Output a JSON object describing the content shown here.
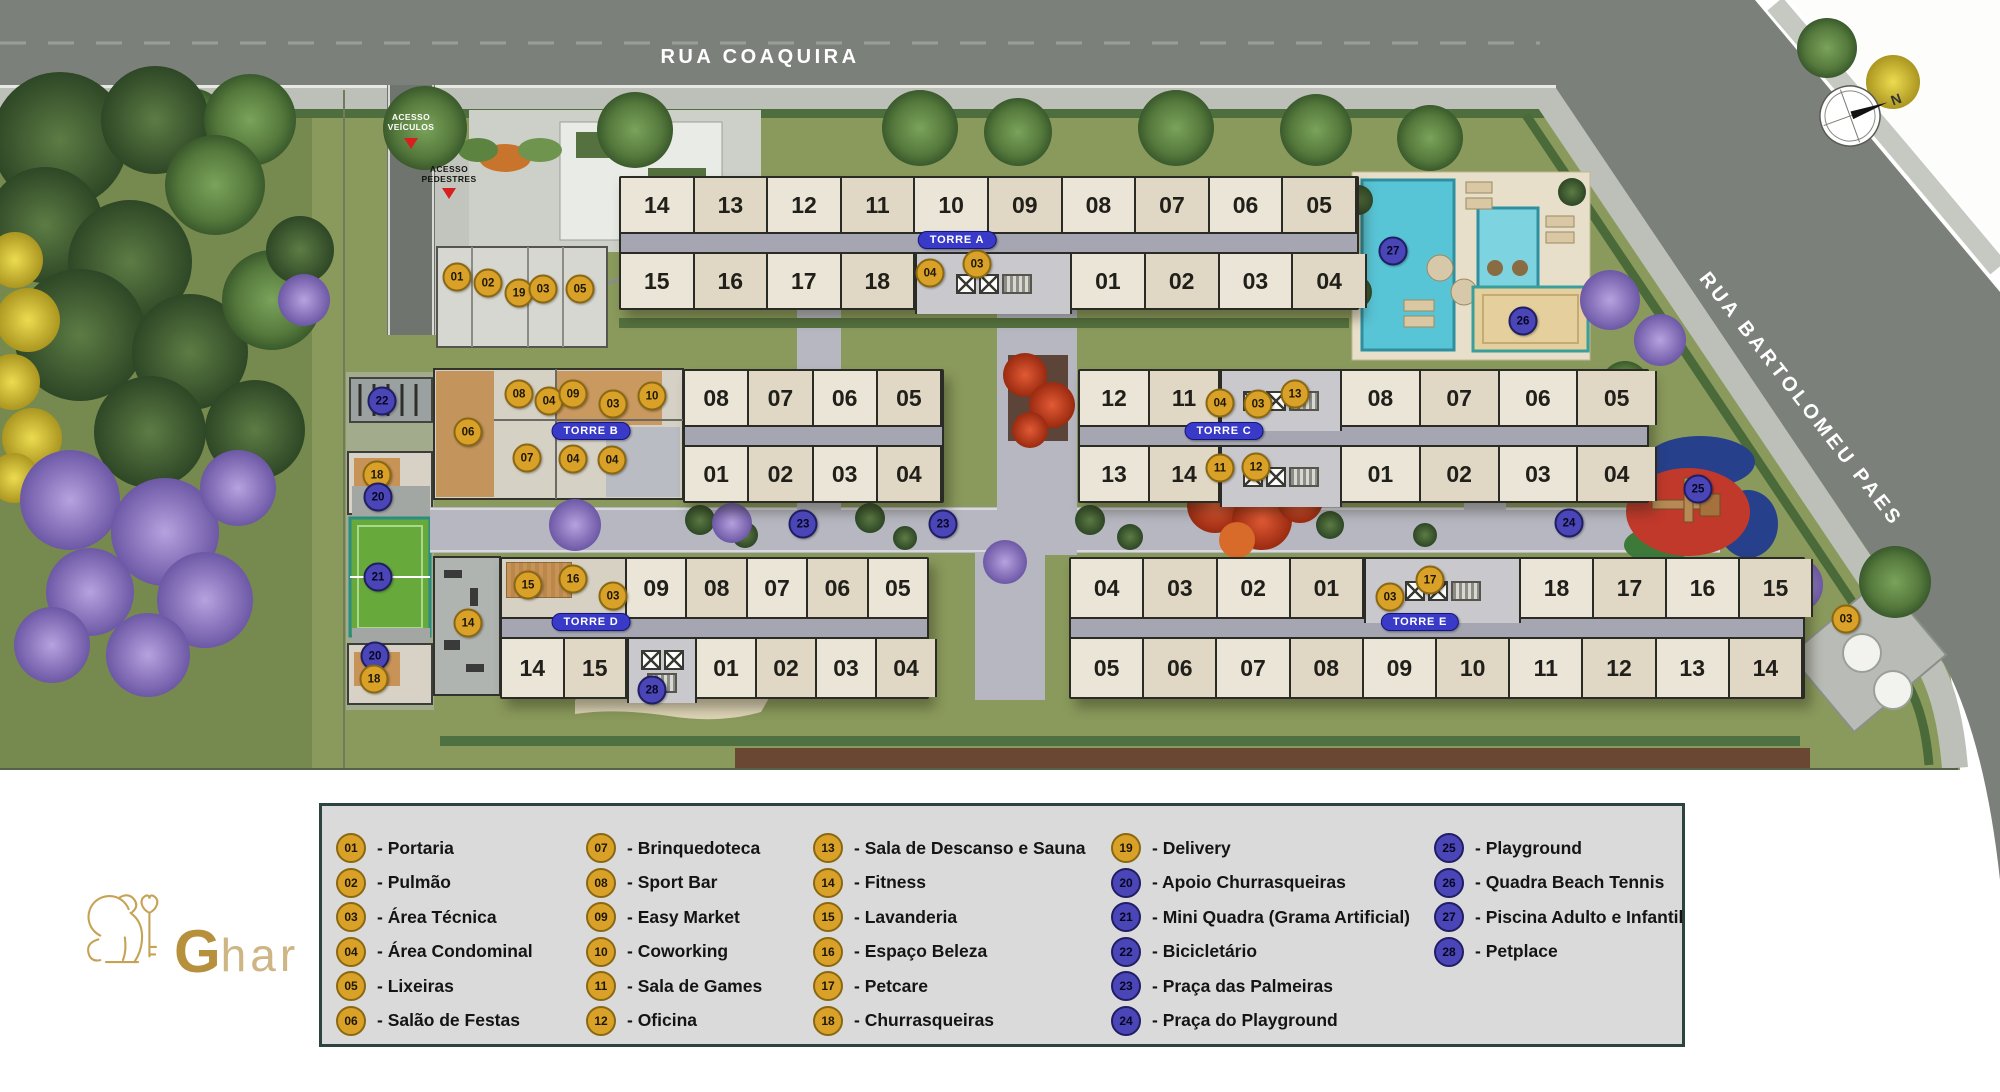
{
  "streets": {
    "top": "RUA COAQUIRA",
    "side": "RUA BARTOLOMEU PAES"
  },
  "access": {
    "vehicles": "ACESSO\nVEÍCULOS",
    "pedestrians": "ACESSO\nPEDESTRES"
  },
  "compass": {
    "north": "N"
  },
  "logo": {
    "initial": "G",
    "rest": "har"
  },
  "colors": {
    "gold": "#DAA128",
    "blue": "#4B46B8",
    "pill_blue": "#3A3AC8",
    "legend_bg": "#DADADA"
  },
  "towers": [
    {
      "id": "a",
      "label": "TORRE A",
      "x": 619,
      "y": 176,
      "w": 736,
      "h": 130,
      "top": [
        {
          "cells": [
            "14",
            "13",
            "12",
            "11",
            "10",
            "09",
            "08",
            "07",
            "06",
            "05"
          ]
        }
      ],
      "bottom": [
        {
          "cells": [
            "15",
            "16",
            "17",
            "18"
          ],
          "w": 294
        },
        {
          "core": 147
        },
        {
          "cells": [
            "01",
            "02",
            "03",
            "04"
          ],
          "w": 295
        }
      ],
      "pill": {
        "x": 957,
        "y": 240
      }
    },
    {
      "id": "b",
      "label": "TORRE B",
      "x": 683,
      "y": 369,
      "w": 257,
      "h": 130,
      "top": [
        {
          "cells": [
            "08",
            "07",
            "06",
            "05"
          ]
        }
      ],
      "bottom": [
        {
          "cells": [
            "01",
            "02",
            "03",
            "04"
          ]
        }
      ],
      "pill": {
        "x": 591,
        "y": 431
      }
    },
    {
      "id": "c",
      "label": "TORRE C",
      "x": 1078,
      "y": 369,
      "w": 567,
      "h": 130,
      "top": [
        {
          "cells": [
            "12",
            "11"
          ],
          "w": 140
        },
        {
          "core": 112
        },
        {
          "cells": [
            "08",
            "07",
            "06",
            "05"
          ],
          "w": 315
        }
      ],
      "bottom": [
        {
          "cells": [
            "13",
            "14"
          ],
          "w": 140
        },
        {
          "core": 112
        },
        {
          "cells": [
            "01",
            "02",
            "03",
            "04"
          ],
          "w": 315
        }
      ],
      "pill": {
        "x": 1224,
        "y": 431
      }
    },
    {
      "id": "d",
      "label": "TORRE D",
      "x": 500,
      "y": 557,
      "w": 425,
      "h": 138,
      "top": [
        {
          "amenity": 123
        },
        {
          "cells": [
            "09",
            "08",
            "07",
            "06",
            "05"
          ],
          "w": 302
        }
      ],
      "bottom": [
        {
          "cells": [
            "14",
            "15"
          ],
          "w": 125
        },
        {
          "core": 60
        },
        {
          "cells": [
            "01",
            "02",
            "03",
            "04"
          ],
          "w": 240
        }
      ],
      "pill": {
        "x": 591,
        "y": 622
      }
    },
    {
      "id": "e",
      "label": "TORRE E",
      "x": 1069,
      "y": 557,
      "w": 732,
      "h": 138,
      "top": [
        {
          "cells": [
            "04",
            "03",
            "02",
            "01"
          ],
          "w": 293
        },
        {
          "core": 147
        },
        {
          "cells": [
            "18",
            "17",
            "16",
            "15"
          ],
          "w": 292
        }
      ],
      "bottom": [
        {
          "cells": [
            "05",
            "06",
            "07",
            "08",
            "09",
            "10",
            "11",
            "12",
            "13",
            "14"
          ]
        }
      ],
      "pill": {
        "x": 1420,
        "y": 622
      }
    }
  ],
  "markers": [
    {
      "n": "01",
      "c": "g",
      "x": 457,
      "y": 277
    },
    {
      "n": "02",
      "c": "g",
      "x": 488,
      "y": 283
    },
    {
      "n": "19",
      "c": "g",
      "x": 519,
      "y": 293
    },
    {
      "n": "03",
      "c": "g",
      "x": 543,
      "y": 289
    },
    {
      "n": "05",
      "c": "g",
      "x": 580,
      "y": 289
    },
    {
      "n": "22",
      "c": "b",
      "x": 382,
      "y": 401
    },
    {
      "n": "18",
      "c": "g",
      "x": 377,
      "y": 475
    },
    {
      "n": "20",
      "c": "b",
      "x": 378,
      "y": 497
    },
    {
      "n": "21",
      "c": "b",
      "x": 378,
      "y": 577
    },
    {
      "n": "20",
      "c": "b",
      "x": 375,
      "y": 656
    },
    {
      "n": "18",
      "c": "g",
      "x": 374,
      "y": 679
    },
    {
      "n": "04",
      "c": "g",
      "x": 930,
      "y": 273
    },
    {
      "n": "03",
      "c": "g",
      "x": 977,
      "y": 264
    },
    {
      "n": "06",
      "c": "g",
      "x": 468,
      "y": 432
    },
    {
      "n": "08",
      "c": "g",
      "x": 519,
      "y": 394
    },
    {
      "n": "04",
      "c": "g",
      "x": 549,
      "y": 401
    },
    {
      "n": "09",
      "c": "g",
      "x": 573,
      "y": 394
    },
    {
      "n": "03",
      "c": "g",
      "x": 613,
      "y": 404
    },
    {
      "n": "10",
      "c": "g",
      "x": 652,
      "y": 396
    },
    {
      "n": "07",
      "c": "g",
      "x": 527,
      "y": 458
    },
    {
      "n": "04",
      "c": "g",
      "x": 573,
      "y": 459
    },
    {
      "n": "04",
      "c": "g",
      "x": 612,
      "y": 460
    },
    {
      "n": "04",
      "c": "g",
      "x": 1220,
      "y": 403
    },
    {
      "n": "03",
      "c": "g",
      "x": 1258,
      "y": 404
    },
    {
      "n": "13",
      "c": "g",
      "x": 1295,
      "y": 394
    },
    {
      "n": "11",
      "c": "g",
      "x": 1220,
      "y": 468
    },
    {
      "n": "12",
      "c": "g",
      "x": 1256,
      "y": 467
    },
    {
      "n": "14",
      "c": "g",
      "x": 468,
      "y": 623
    },
    {
      "n": "15",
      "c": "g",
      "x": 528,
      "y": 585
    },
    {
      "n": "16",
      "c": "g",
      "x": 573,
      "y": 579
    },
    {
      "n": "03",
      "c": "g",
      "x": 613,
      "y": 596
    },
    {
      "n": "28",
      "c": "b",
      "x": 652,
      "y": 690
    },
    {
      "n": "03",
      "c": "g",
      "x": 1390,
      "y": 597
    },
    {
      "n": "17",
      "c": "g",
      "x": 1430,
      "y": 580
    },
    {
      "n": "27",
      "c": "b",
      "x": 1393,
      "y": 251
    },
    {
      "n": "26",
      "c": "b",
      "x": 1523,
      "y": 321
    },
    {
      "n": "23",
      "c": "b",
      "x": 803,
      "y": 524
    },
    {
      "n": "23",
      "c": "b",
      "x": 943,
      "y": 524
    },
    {
      "n": "24",
      "c": "b",
      "x": 1569,
      "y": 523
    },
    {
      "n": "25",
      "c": "b",
      "x": 1698,
      "y": 489
    },
    {
      "n": "03",
      "c": "g",
      "x": 1846,
      "y": 619
    }
  ],
  "legend": {
    "columns": [
      {
        "items": [
          {
            "n": "01",
            "c": "g",
            "label": "- Portaria"
          },
          {
            "n": "02",
            "c": "g",
            "label": "- Pulmão"
          },
          {
            "n": "03",
            "c": "g",
            "label": "- Área Técnica"
          },
          {
            "n": "04",
            "c": "g",
            "label": "- Área Condominal"
          },
          {
            "n": "05",
            "c": "g",
            "label": "- Lixeiras"
          },
          {
            "n": "06",
            "c": "g",
            "label": "- Salão de Festas"
          }
        ]
      },
      {
        "items": [
          {
            "n": "07",
            "c": "g",
            "label": "- Brinquedoteca"
          },
          {
            "n": "08",
            "c": "g",
            "label": "- Sport Bar"
          },
          {
            "n": "09",
            "c": "g",
            "label": "- Easy Market"
          },
          {
            "n": "10",
            "c": "g",
            "label": "- Coworking"
          },
          {
            "n": "11",
            "c": "g",
            "label": "- Sala de Games"
          },
          {
            "n": "12",
            "c": "g",
            "label": "- Oficina"
          }
        ]
      },
      {
        "items": [
          {
            "n": "13",
            "c": "g",
            "label": "- Sala de Descanso e Sauna"
          },
          {
            "n": "14",
            "c": "g",
            "label": "- Fitness"
          },
          {
            "n": "15",
            "c": "g",
            "label": "- Lavanderia"
          },
          {
            "n": "16",
            "c": "g",
            "label": "- Espaço Beleza"
          },
          {
            "n": "17",
            "c": "g",
            "label": "- Petcare"
          },
          {
            "n": "18",
            "c": "g",
            "label": "- Churrasqueiras"
          }
        ]
      },
      {
        "items": [
          {
            "n": "19",
            "c": "g",
            "label": "- Delivery"
          },
          {
            "n": "20",
            "c": "b",
            "label": "- Apoio Churrasqueiras"
          },
          {
            "n": "21",
            "c": "b",
            "label": "- Mini Quadra (Grama Artificial)"
          },
          {
            "n": "22",
            "c": "b",
            "label": "- Bicicletário"
          },
          {
            "n": "23",
            "c": "b",
            "label": "- Praça das Palmeiras"
          },
          {
            "n": "24",
            "c": "b",
            "label": "- Praça do Playground"
          }
        ]
      },
      {
        "items": [
          {
            "n": "25",
            "c": "b",
            "label": "- Playground"
          },
          {
            "n": "26",
            "c": "b",
            "label": "- Quadra Beach Tennis"
          },
          {
            "n": "27",
            "c": "b",
            "label": "- Piscina Adulto e Infantil"
          },
          {
            "n": "28",
            "c": "b",
            "label": "- Petplace"
          }
        ]
      }
    ]
  }
}
